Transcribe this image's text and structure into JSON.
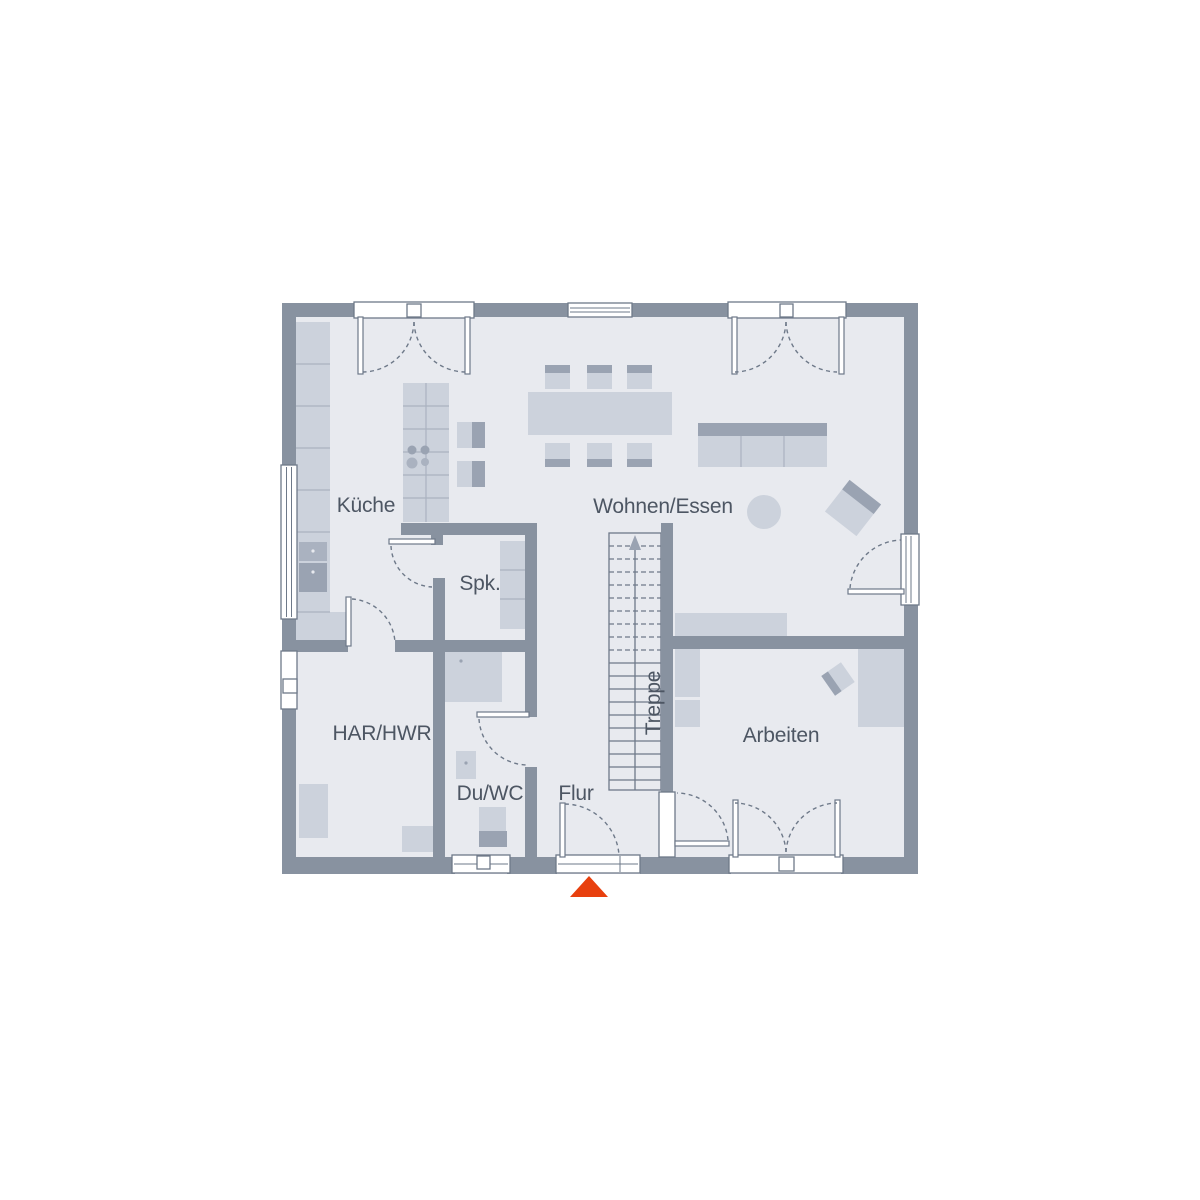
{
  "plan": {
    "labels": {
      "kueche": "Küche",
      "wohnen_essen": "Wohnen/Essen",
      "spk": "Spk.",
      "har_hwr": "HAR/HWR",
      "du_wc": "Du/WC",
      "flur": "Flur",
      "treppe": "Treppe",
      "arbeiten": "Arbeiten"
    },
    "colors": {
      "background": "#ffffff",
      "floor": "#e8eaef",
      "wall": "#8892a0",
      "outline": "#6e7989",
      "furniture_light": "#ccd2dc",
      "furniture_mid": "#aab2c0",
      "furniture_dark": "#9aa3b2",
      "label_text": "#4d5663",
      "entrance_arrow": "#e8400e"
    }
  }
}
